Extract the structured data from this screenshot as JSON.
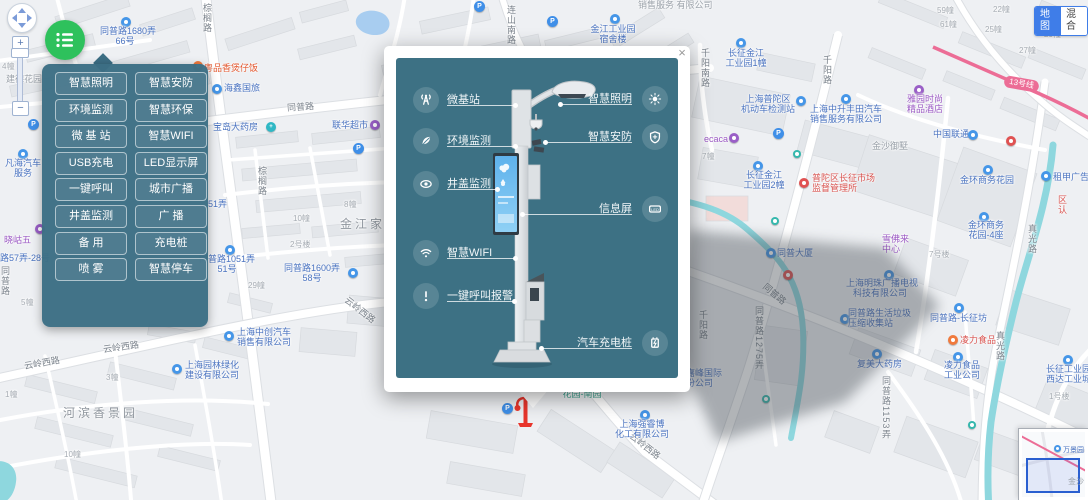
{
  "controls": {
    "zoom_in": "+",
    "zoom_out": "−"
  },
  "map_type": {
    "options": [
      {
        "label": "地图",
        "active": true
      },
      {
        "label": "混合",
        "active": false
      }
    ]
  },
  "metro": {
    "line_badge": "13号线"
  },
  "panel": {
    "buttons": [
      {
        "label": "智慧照明"
      },
      {
        "label": "智慧安防"
      },
      {
        "label": "环境监测"
      },
      {
        "label": "智慧环保"
      },
      {
        "label": "微 基 站"
      },
      {
        "label": "智慧WIFI"
      },
      {
        "label": "USB充电"
      },
      {
        "label": "LED显示屏"
      },
      {
        "label": "一键呼叫"
      },
      {
        "label": "城市广播"
      },
      {
        "label": "井盖监测"
      },
      {
        "label": "广  播"
      },
      {
        "label": "备  用"
      },
      {
        "label": "充电桩"
      },
      {
        "label": "喷  雾"
      },
      {
        "label": "智慧停车"
      }
    ]
  },
  "popup": {
    "close": "×",
    "led_text": "LED",
    "features_left": [
      {
        "icon": "antenna-icon",
        "label": "微基站"
      },
      {
        "icon": "leaf-icon",
        "label": "环境监测"
      },
      {
        "icon": "eye-icon",
        "label": "井盖监测"
      },
      {
        "icon": "wifi-icon",
        "label": "智慧WIFI"
      },
      {
        "icon": "alarm-icon",
        "label": "一键呼叫报警"
      }
    ],
    "features_right": [
      {
        "icon": "sun-icon",
        "label": "智慧照明"
      },
      {
        "icon": "shield-icon",
        "label": "智慧安防"
      },
      {
        "icon": "led-icon",
        "label": "信息屏"
      },
      {
        "icon": "charger-icon",
        "label": "汽车充电桩"
      }
    ]
  },
  "minimap": {
    "poi": "万景园",
    "area": "金沙"
  },
  "colors": {
    "accent_green": "#2ec15c",
    "panel_teal": "#3c6e84",
    "popup_teal": "#3d7184",
    "poi_blue": "#4596e8",
    "metro_pink": "#ec6d96",
    "marker_red": "#e8352c",
    "toggle_blue": "#3f7de8"
  },
  "map": {
    "labels": [
      {
        "ic": "blue",
        "x": 121,
        "y": 17
      },
      {
        "lines": [
          "同普路1680弄",
          "66号"
        ],
        "x": 100,
        "y": 26,
        "ty": "blue",
        "al": "c",
        "w": 50
      },
      {
        "t": "建德花园",
        "x": 6,
        "y": 74,
        "ty": "area2"
      },
      {
        "t": "4幢",
        "x": 2,
        "y": 62,
        "ty": "bld"
      },
      {
        "ic": "orange",
        "x": 193,
        "y": 61
      },
      {
        "t": "粤品香煲仔饭",
        "x": 204,
        "y": 63,
        "ty": "orange"
      },
      {
        "ic": "blue",
        "x": 212,
        "y": 84
      },
      {
        "t": "海鑫国旅",
        "x": 224,
        "y": 83,
        "ty": "blue"
      },
      {
        "t": "同普路",
        "x": 287,
        "y": 102,
        "ty": "road",
        "rot": -4
      },
      {
        "t": "宝岛大药房",
        "x": 213,
        "y": 122,
        "ty": "blue"
      },
      {
        "ic": "teal",
        "x": 266,
        "y": 122,
        "g": "+"
      },
      {
        "t": "联华超市",
        "x": 332,
        "y": 120,
        "ty": "blue"
      },
      {
        "ic": "purple",
        "x": 370,
        "y": 120
      },
      {
        "ic": "pblue",
        "x": 353,
        "y": 143,
        "g": "P"
      },
      {
        "ic": "pblue",
        "x": 474,
        "y": 1,
        "g": "P"
      },
      {
        "ic": "pblue",
        "x": 547,
        "y": 16,
        "g": "P"
      },
      {
        "ic": "pblue",
        "x": 773,
        "y": 128,
        "g": "P"
      },
      {
        "ic": "pblue",
        "x": 28,
        "y": 119,
        "g": "P"
      },
      {
        "t": "棕榈路",
        "x": 202,
        "y": 3,
        "ty": "road",
        "vert": 1
      },
      {
        "t": "棕榈路",
        "x": 257,
        "y": 166,
        "ty": "road",
        "vert": 1
      },
      {
        "t": "金江家园",
        "x": 340,
        "y": 219,
        "ty": "area"
      },
      {
        "t": "8幢",
        "x": 344,
        "y": 200,
        "ty": "bld"
      },
      {
        "t": "10幢",
        "x": 293,
        "y": 214,
        "ty": "bld"
      },
      {
        "t": "2号楼",
        "x": 290,
        "y": 240,
        "ty": "bld"
      },
      {
        "t": "29幢",
        "x": 248,
        "y": 281,
        "ty": "bld"
      },
      {
        "t": "51弄",
        "x": 208,
        "y": 199,
        "ty": "blue"
      },
      {
        "ic": "blue",
        "x": 225,
        "y": 245
      },
      {
        "lines": [
          "同普路1051弄",
          "51号"
        ],
        "x": 198,
        "y": 254,
        "ty": "blue",
        "al": "c",
        "w": 58
      },
      {
        "lines": [
          "同普路1600弄",
          "58号"
        ],
        "x": 283,
        "y": 263,
        "ty": "blue",
        "al": "c",
        "w": 58
      },
      {
        "ic": "blue",
        "x": 348,
        "y": 268
      },
      {
        "ic": "blue",
        "x": 224,
        "y": 331
      },
      {
        "lines": [
          "上海中创汽车",
          "销售有限公司"
        ],
        "x": 237,
        "y": 327,
        "ty": "blue"
      },
      {
        "t": "云岭西路",
        "x": 24,
        "y": 358,
        "ty": "road",
        "rot": -10
      },
      {
        "t": "云岭西路",
        "x": 103,
        "y": 342,
        "ty": "road",
        "rot": -8
      },
      {
        "t": "云岭西路",
        "x": 342,
        "y": 305,
        "ty": "road",
        "rot": 38
      },
      {
        "t": "云岭西路",
        "x": 627,
        "y": 441,
        "ty": "road",
        "rot": 38
      },
      {
        "ic": "blue",
        "x": 172,
        "y": 364
      },
      {
        "lines": [
          "上海园林绿化",
          "建设有限公司"
        ],
        "x": 185,
        "y": 360,
        "ty": "blue"
      },
      {
        "t": "河滨香景园",
        "x": 63,
        "y": 408,
        "ty": "area"
      },
      {
        "t": "10幢",
        "x": 64,
        "y": 450,
        "ty": "bld"
      },
      {
        "t": "3幢",
        "x": 106,
        "y": 373,
        "ty": "bld"
      },
      {
        "t": "1幢",
        "x": 5,
        "y": 390,
        "ty": "bld"
      },
      {
        "ic": "purple",
        "x": 35,
        "y": 224
      },
      {
        "t": "晓岵五",
        "x": 4,
        "y": 235,
        "ty": "purple"
      },
      {
        "t": "路57弄-28号",
        "x": 0,
        "y": 253,
        "ty": "blue"
      },
      {
        "t": "5幢",
        "x": 21,
        "y": 298,
        "ty": "bld"
      },
      {
        "t": "同普路",
        "x": 0,
        "y": 266,
        "ty": "road",
        "vert": 1
      },
      {
        "ic": "blue",
        "x": 18,
        "y": 149
      },
      {
        "lines": [
          "凡海汽车",
          "服务"
        ],
        "x": 2,
        "y": 158,
        "ty": "blue",
        "al": "c",
        "w": 42
      },
      {
        "t": "连山南路",
        "x": 506,
        "y": 5,
        "ty": "road",
        "vert": 1
      },
      {
        "ic": "blue",
        "x": 610,
        "y": 14
      },
      {
        "lines": [
          "金江工业园",
          "宿舍楼"
        ],
        "x": 588,
        "y": 24,
        "ty": "blue",
        "al": "c",
        "w": 50
      },
      {
        "t": "销售服务 有限公司",
        "x": 638,
        "y": 0,
        "ty": "area2"
      },
      {
        "ic": "blue",
        "x": 736,
        "y": 38
      },
      {
        "lines": [
          "长征金江",
          "工业园1幢"
        ],
        "x": 722,
        "y": 48,
        "ty": "blue",
        "al": "c",
        "w": 48
      },
      {
        "t": "千阳南路",
        "x": 700,
        "y": 48,
        "ty": "road",
        "vert": 1
      },
      {
        "t": "千阳路",
        "x": 822,
        "y": 55,
        "ty": "road",
        "vert": 1
      },
      {
        "lines": [
          "上海普陀区",
          "机动车检测站"
        ],
        "x": 740,
        "y": 94,
        "ty": "blue",
        "al": "c",
        "w": 56
      },
      {
        "ic": "blue",
        "x": 796,
        "y": 96
      },
      {
        "ic": "blue",
        "x": 841,
        "y": 94
      },
      {
        "lines": [
          "上海中升丰田汽车",
          "销售服务有限公司"
        ],
        "x": 810,
        "y": 104,
        "ty": "blue"
      },
      {
        "t": "ecaca",
        "x": 704,
        "y": 134,
        "ty": "purple"
      },
      {
        "ic": "purple",
        "x": 729,
        "y": 133
      },
      {
        "t": "7幢",
        "x": 702,
        "y": 152,
        "ty": "bld"
      },
      {
        "ic": "blue",
        "x": 753,
        "y": 161
      },
      {
        "lines": [
          "长征金江",
          "工业园2幢"
        ],
        "x": 740,
        "y": 170,
        "ty": "blue",
        "al": "c",
        "w": 48
      },
      {
        "ic": "red",
        "x": 799,
        "y": 178
      },
      {
        "lines": [
          "普陀区长征市场",
          "监督管理所"
        ],
        "x": 812,
        "y": 173,
        "ty": "red"
      },
      {
        "t": "中国联通",
        "x": 933,
        "y": 129,
        "ty": "blue"
      },
      {
        "ic": "blue",
        "x": 968,
        "y": 130
      },
      {
        "ic": "purple",
        "x": 914,
        "y": 85
      },
      {
        "lines": [
          "雅园时尚",
          "精品酒店"
        ],
        "x": 903,
        "y": 94,
        "ty": "purple",
        "al": "c",
        "w": 44
      },
      {
        "ic": "red",
        "x": 1006,
        "y": 136
      },
      {
        "t": "金沙御墅",
        "x": 872,
        "y": 141,
        "ty": "area2"
      },
      {
        "ic": "blue",
        "x": 983,
        "y": 165
      },
      {
        "t": "金环商务花园",
        "x": 960,
        "y": 175,
        "ty": "blue"
      },
      {
        "ic": "blue",
        "x": 1041,
        "y": 171
      },
      {
        "t": "租甲广告",
        "x": 1053,
        "y": 172,
        "ty": "blue"
      },
      {
        "t": "区认",
        "x": 1057,
        "y": 195,
        "ty": "red",
        "vert": 1
      },
      {
        "t": "真光路",
        "x": 1027,
        "y": 224,
        "ty": "road",
        "vert": 1
      },
      {
        "t": "真光路",
        "x": 995,
        "y": 331,
        "ty": "road",
        "vert": 1
      },
      {
        "ic": "blue",
        "x": 979,
        "y": 212
      },
      {
        "lines": [
          "金环商务",
          "花园-4座"
        ],
        "x": 964,
        "y": 220,
        "ty": "blue",
        "al": "c",
        "w": 44
      },
      {
        "t": "7号楼",
        "x": 929,
        "y": 250,
        "ty": "bld"
      },
      {
        "lines": [
          "雪佛来",
          "中心"
        ],
        "x": 882,
        "y": 234,
        "ty": "purple"
      },
      {
        "ic": "blue",
        "x": 766,
        "y": 248
      },
      {
        "t": "同普大厦",
        "x": 777,
        "y": 248,
        "ty": "blue"
      },
      {
        "ic": "redarch",
        "x": 783,
        "y": 270
      },
      {
        "t": "同普路",
        "x": 761,
        "y": 289,
        "ty": "road",
        "rot": 40
      },
      {
        "t": "千阳路",
        "x": 698,
        "y": 310,
        "ty": "road",
        "vert": 1
      },
      {
        "t": "同普路1275弄",
        "x": 754,
        "y": 306,
        "ty": "road",
        "vert": 1
      },
      {
        "ic": "blue",
        "x": 884,
        "y": 270
      },
      {
        "lines": [
          "上海明珠广播电视",
          "科技有限公司"
        ],
        "x": 846,
        "y": 278,
        "ty": "blue",
        "al": "c",
        "w": 68
      },
      {
        "ic": "blue",
        "x": 840,
        "y": 314
      },
      {
        "lines": [
          "同普路生活垃圾",
          "压缩收集站"
        ],
        "x": 848,
        "y": 308,
        "ty": "blue"
      },
      {
        "lines": [
          "嘉峰国际",
          "份公司"
        ],
        "x": 686,
        "y": 368,
        "ty": "blue"
      },
      {
        "ic": "blue",
        "x": 872,
        "y": 349
      },
      {
        "t": "复美大药房",
        "x": 857,
        "y": 359,
        "ty": "blue"
      },
      {
        "ic": "blue",
        "x": 954,
        "y": 303
      },
      {
        "t": "同普路-长征坊",
        "x": 930,
        "y": 313,
        "ty": "blue"
      },
      {
        "ic": "orange",
        "x": 948,
        "y": 335
      },
      {
        "t": "凌力食品",
        "x": 960,
        "y": 335,
        "ty": "red"
      },
      {
        "ic": "blue",
        "x": 953,
        "y": 352
      },
      {
        "lines": [
          "凌力食品",
          "工业公司"
        ],
        "x": 940,
        "y": 360,
        "ty": "blue",
        "al": "c",
        "w": 44
      },
      {
        "ic": "blue",
        "x": 1063,
        "y": 355
      },
      {
        "lines": [
          "长征工业园",
          "西达工业城"
        ],
        "x": 1046,
        "y": 364,
        "ty": "blue"
      },
      {
        "t": "1号楼",
        "x": 1049,
        "y": 392,
        "ty": "bld"
      },
      {
        "t": "同普路1153弄",
        "x": 881,
        "y": 376,
        "ty": "road",
        "vert": 1
      },
      {
        "ic": "blue",
        "x": 640,
        "y": 410
      },
      {
        "lines": [
          "上海强睿博",
          "化工有限公司"
        ],
        "x": 615,
        "y": 419,
        "ty": "blue",
        "al": "c",
        "w": 54
      },
      {
        "lines": [
          "金环商务",
          "花园-南园"
        ],
        "x": 560,
        "y": 379,
        "ty": "green",
        "al": "c",
        "w": 44
      },
      {
        "ic": "pblue",
        "x": 502,
        "y": 403,
        "g": "P"
      },
      {
        "ic": "teal2",
        "x": 793,
        "y": 150
      },
      {
        "ic": "teal2",
        "x": 771,
        "y": 217
      },
      {
        "ic": "teal2",
        "x": 762,
        "y": 395
      },
      {
        "ic": "teal2",
        "x": 968,
        "y": 421
      },
      {
        "t": "22幢",
        "x": 993,
        "y": 5,
        "ty": "bld"
      },
      {
        "t": "59幢",
        "x": 937,
        "y": 6,
        "ty": "bld"
      },
      {
        "t": "61幢",
        "x": 940,
        "y": 20,
        "ty": "bld"
      },
      {
        "t": "25幢",
        "x": 985,
        "y": 25,
        "ty": "bld"
      },
      {
        "t": "20幢",
        "x": 1044,
        "y": 30,
        "ty": "bld"
      },
      {
        "t": "27幢",
        "x": 1019,
        "y": 46,
        "ty": "bld"
      }
    ]
  }
}
